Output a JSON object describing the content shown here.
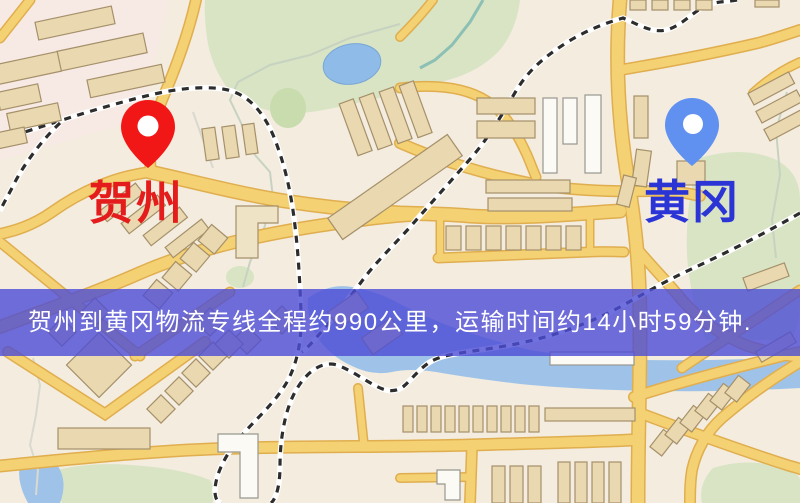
{
  "map": {
    "markers": {
      "origin": {
        "label": "贺州",
        "pin_color": "#f21717",
        "label_color": "#e41c1c",
        "pin_icon": "map-pin"
      },
      "destination": {
        "label": "黄冈",
        "pin_color": "#6191f0",
        "label_color": "#2b35d6",
        "pin_icon": "map-pin"
      }
    },
    "palette": {
      "background": "#f3ecdf",
      "road": "#f4d173",
      "road_casing": "#e0ae4e",
      "building": "#e9d8b0",
      "park": "#d8e4c4",
      "water": "#9fc3e8",
      "railway": "#2d2d2d"
    }
  },
  "banner": {
    "text": "贺州到黄冈物流专线全程约990公里，运输时间约14小时59分钟.",
    "bg_color": "#4c4cd6",
    "text_color": "#ffffff"
  }
}
